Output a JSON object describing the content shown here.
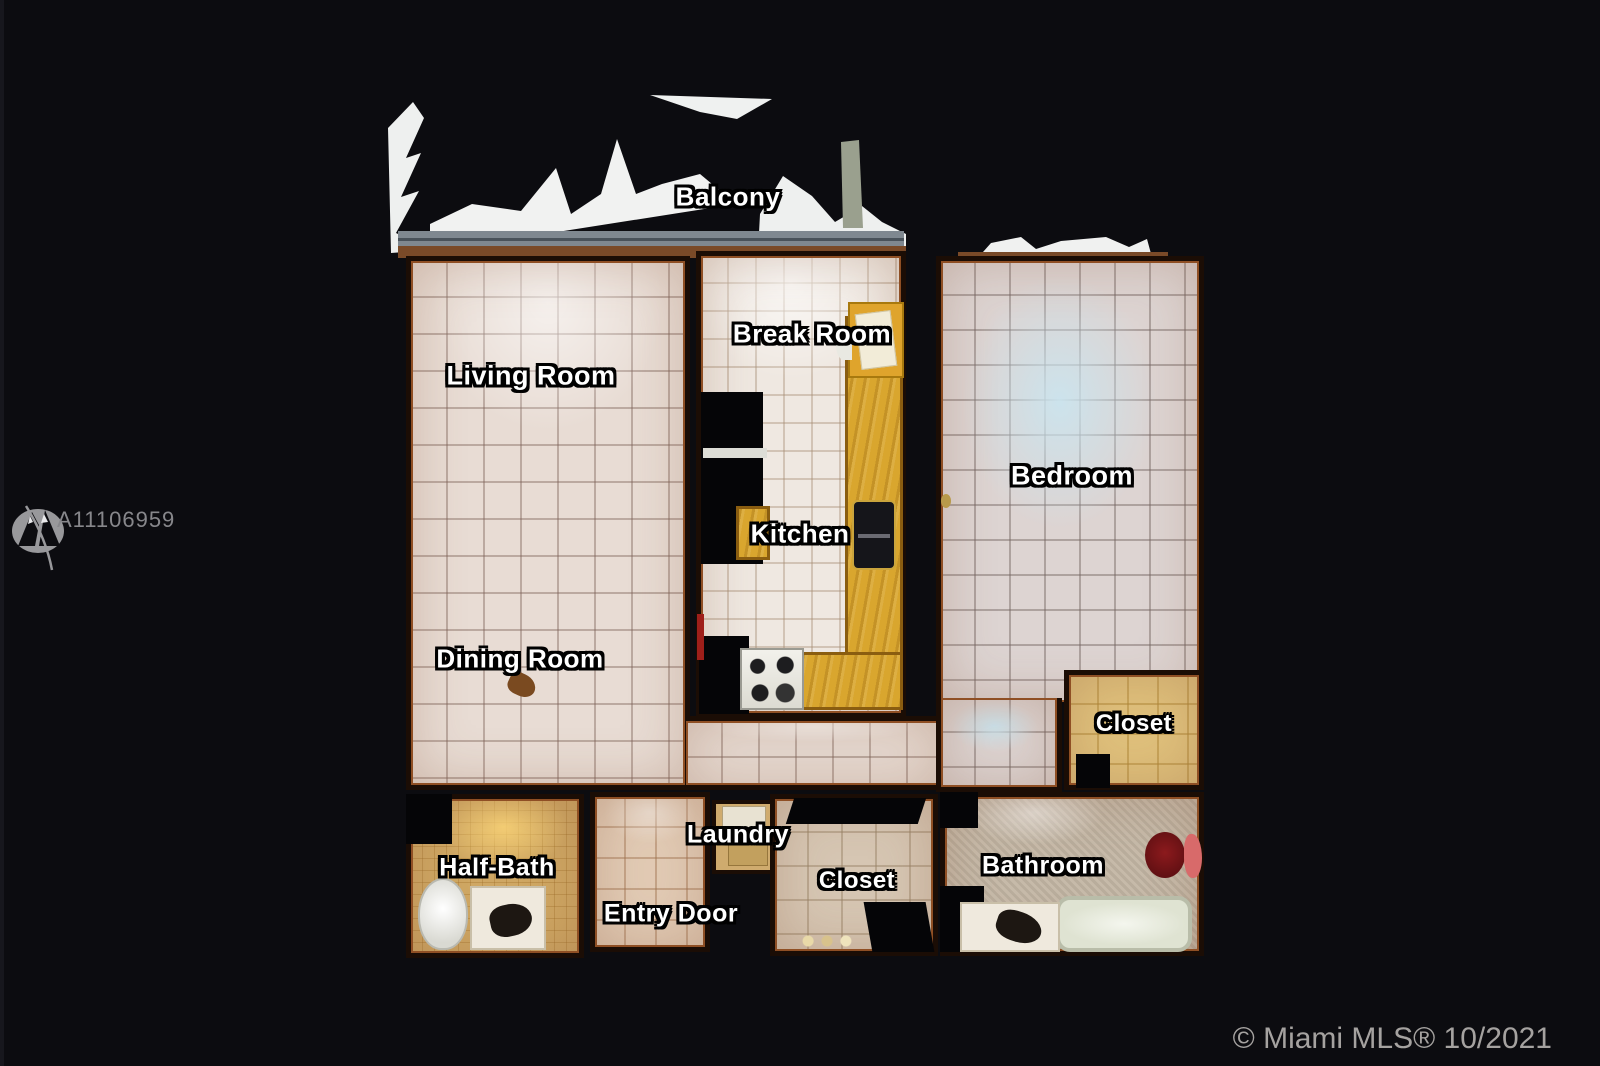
{
  "watermark": {
    "listing_id": "A11106959",
    "logo_icon": "mountain-logo"
  },
  "footer": {
    "copyright": "© Miami MLS® 10/2021"
  },
  "floorplan": {
    "type": "matterport-top-down-scan",
    "rooms": [
      {
        "label": "Balcony"
      },
      {
        "label": "Living Room"
      },
      {
        "label": "Break Room"
      },
      {
        "label": "Kitchen"
      },
      {
        "label": "Bedroom"
      },
      {
        "label": "Dining Room"
      },
      {
        "label": "Closet"
      },
      {
        "label": "Half-Bath"
      },
      {
        "label": "Laundry"
      },
      {
        "label": "Entry Door"
      },
      {
        "label": "Closet"
      },
      {
        "label": "Bathroom"
      }
    ],
    "colors": {
      "background": "#0c0c10",
      "label_text": "#ffffff",
      "label_outline": "#000000",
      "wall_dark": "#1b0d05",
      "wall_rust": "#8f4f24",
      "tile_floor": "#e8dcd4",
      "kitchen_counter": "#d9a62e",
      "balcony_white": "#eff1f0",
      "watermark_gray": "#87878b"
    }
  }
}
